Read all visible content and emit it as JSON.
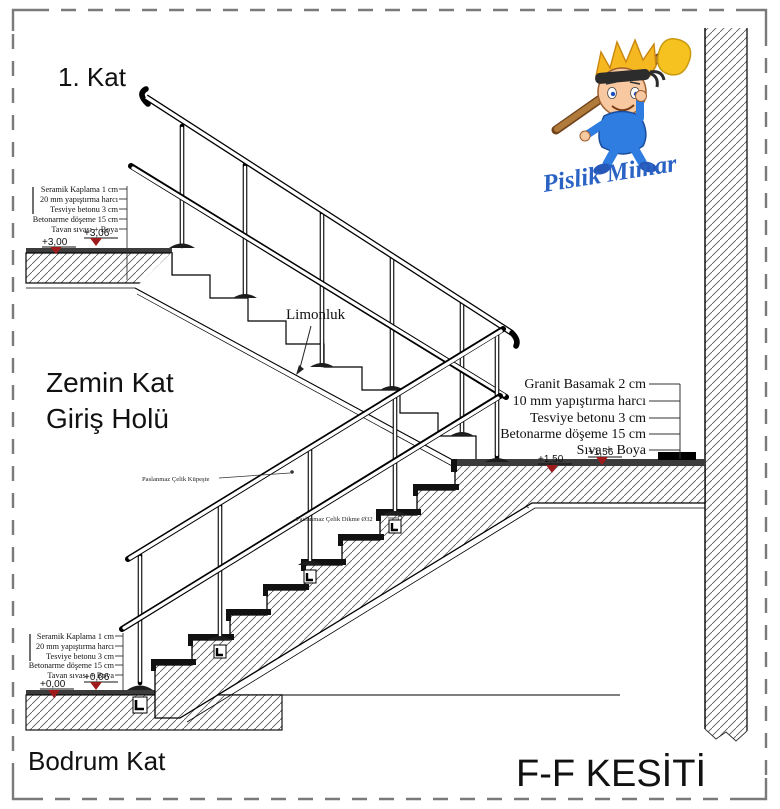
{
  "title": {
    "section": "F-F KESİTİ"
  },
  "floors": {
    "first": "1. Kat",
    "ground_line1": "Zemin Kat",
    "ground_line2": "Giriş Holü",
    "basement": "Bodrum Kat"
  },
  "logo": {
    "brand": "Pislik Mimar"
  },
  "labels": {
    "stringer": "Limonluk",
    "handrail": "Paslanmaz Çelik Küpeşte",
    "baluster": "Paslanmaz Çelik Dikme Ø32"
  },
  "callouts": {
    "floor_top": [
      "Seramik Kaplama 1 cm",
      "20 mm yapıştırma harcı",
      "Tesviye betonu 3 cm",
      "Betonarme döşeme 15 cm",
      "Tavan sıvası + Boya"
    ],
    "floor_bottom": [
      "Seramik Kaplama 1 cm",
      "20 mm yapıştırma harcı",
      "Tesviye betonu 3 cm",
      "Betonarme döşeme 15 cm",
      "Tavan sıvası + Boya"
    ],
    "stair": [
      "Granit Basamak 2 cm",
      "10 mm yapıştırma harcı",
      "Tesviye betonu 3 cm",
      "Betonarme döşeme 15 cm",
      "Sıva + Boya"
    ]
  },
  "elevations": {
    "first_struct": "+3,00",
    "first_finish": "+3,06",
    "landing_struct": "+1,50",
    "landing_finish": "+1,56",
    "basement_struct": "+0,00",
    "basement_finish": "+0,06"
  },
  "colors": {
    "marker_red": "#9e1b1b",
    "logo_blue": "#2a63c4",
    "hair_yellow": "#f6c21f",
    "granite_black": "#111111",
    "hatch_gray": "#4f4f4f"
  }
}
